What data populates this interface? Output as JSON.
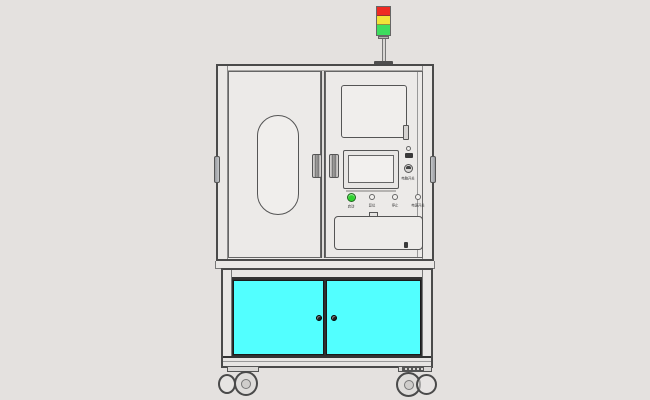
{
  "machine": {
    "colors": {
      "canvas_bg": "#E4E1DF",
      "panel": "#ECEAE8",
      "outline": "#4A4A4A",
      "door_cyan": "#52FFFF",
      "tower_red": "#EF2A23",
      "tower_yellow": "#F2E339",
      "tower_green": "#3DDD5E",
      "start_green": "#2ED32E"
    },
    "signal_tower": {
      "segments": [
        "red",
        "yellow",
        "green"
      ]
    },
    "control_panel": {
      "switch_label": "电脑开关",
      "buttons": [
        {
          "label": "启动"
        },
        {
          "label": "复位"
        },
        {
          "label": "停止"
        },
        {
          "label": "电源开关"
        }
      ]
    }
  }
}
